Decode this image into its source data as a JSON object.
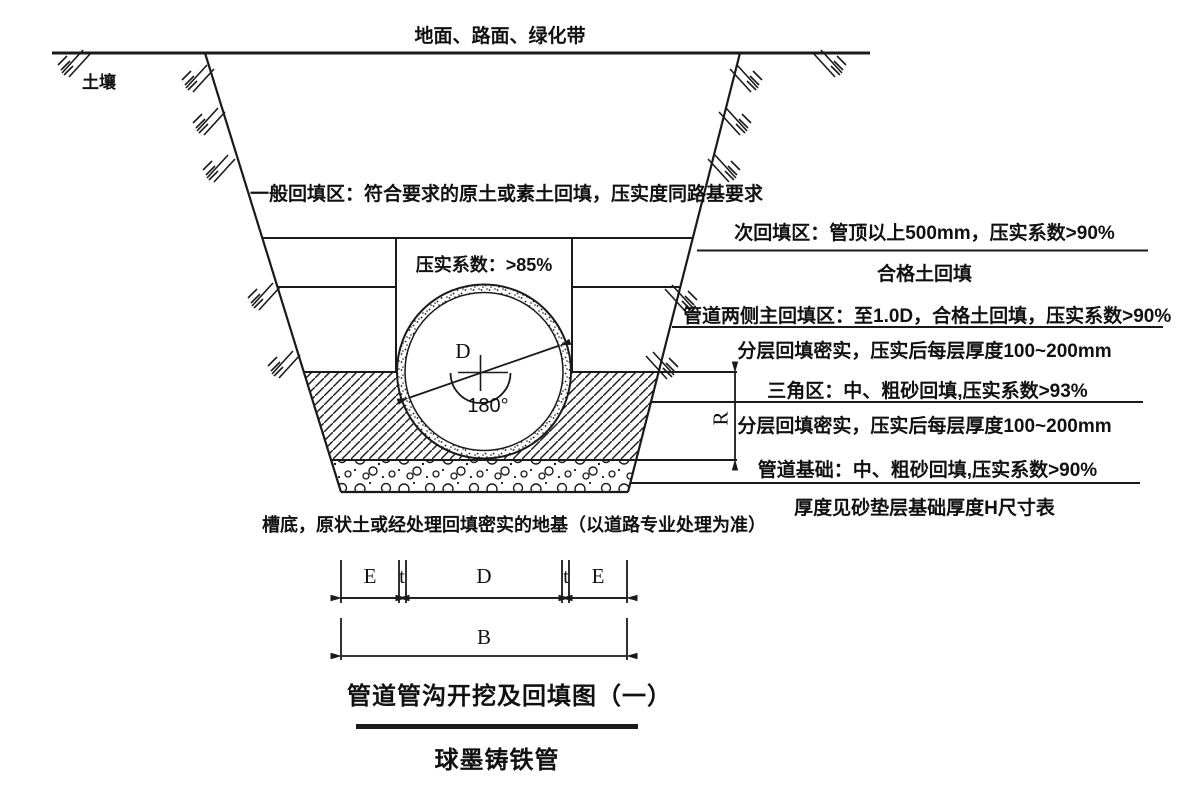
{
  "page": {
    "background_color": "#ffffff",
    "ink_color": "#1a1a1a"
  },
  "surface": {
    "ground_label": "地面、路面、绿化带",
    "soil_label": "土壤"
  },
  "trench": {
    "general_backfill_note": "一般回填区：符合要求的原土或素土回填，压实度同路基要求",
    "compaction_box_label": "压实系数：>85%",
    "trench_bottom_note": "槽底，原状土或经处理回填密实的地基（以道路专业处理为准）"
  },
  "pipe": {
    "diameter_label": "D",
    "bedding_angle_label": "180°"
  },
  "annotations": [
    {
      "text": "次回填区：管顶以上500mm，压实系数>90%",
      "underline": true
    },
    {
      "text": "合格土回填",
      "underline": false
    },
    {
      "text": "管道两侧主回填区：至1.0D，合格土回填，压实系数>90%",
      "underline": true
    },
    {
      "text": "分层回填密实，压实后每层厚度100~200mm",
      "underline": false
    },
    {
      "text": "三角区：中、粗砂回填,压实系数>93%",
      "underline": true
    },
    {
      "text": "分层回填密实，压实后每层厚度100~200mm",
      "underline": false
    },
    {
      "text": "管道基础：中、粗砂回填,压实系数>90%",
      "underline": true
    },
    {
      "text": "厚度见砂垫层基础厚度H尺寸表",
      "underline": false
    }
  ],
  "dimensions": {
    "bedding_thickness": "R",
    "side_clearance_left": "E",
    "wall_thickness_left": "t",
    "pipe_diameter": "D",
    "wall_thickness_right": "t",
    "side_clearance_right": "E",
    "trench_width": "B"
  },
  "footer": {
    "title": "管道管沟开挖及回填图（一）",
    "subtitle": "球墨铸铁管"
  }
}
